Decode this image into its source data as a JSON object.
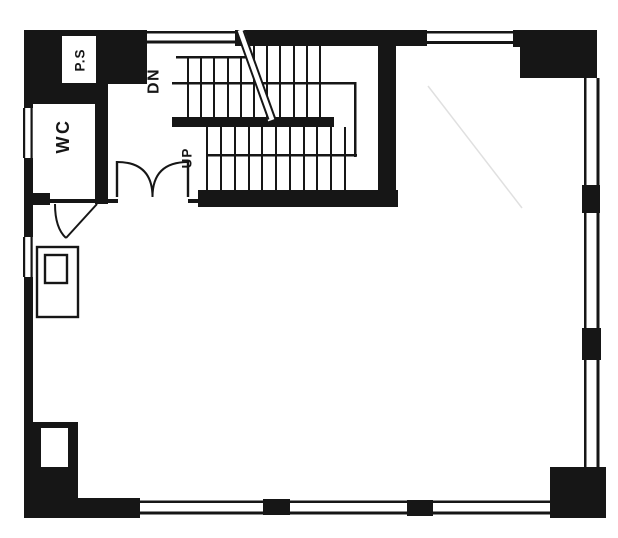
{
  "document": {
    "type": "architectural-floor-plan",
    "canvas": {
      "width": 618,
      "height": 538
    }
  },
  "colors": {
    "ink": "#161616",
    "paper": "#ffffff",
    "artifact": "#e0e0e0"
  },
  "rooms": {
    "pipe_shaft_label": "P.S",
    "toilet_label": "WC"
  },
  "stairs": {
    "down_label": "DN",
    "up_label": "UP"
  }
}
